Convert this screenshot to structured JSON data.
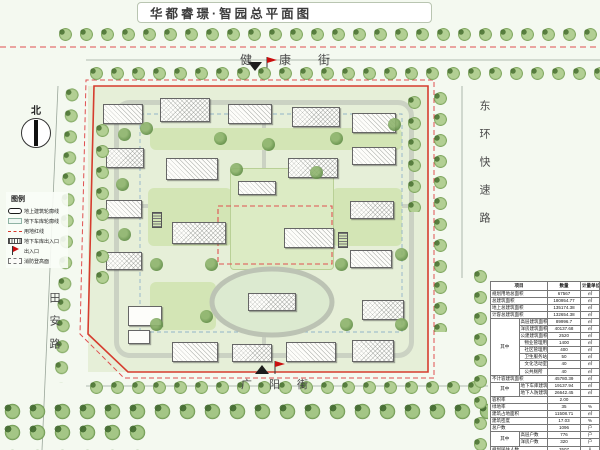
{
  "title": "华都睿璟·智园总平面图",
  "north_label": "北",
  "streets": {
    "top": "健康街",
    "bottom": "广阳街",
    "left": "田安路",
    "right": "东环快速路"
  },
  "legend": {
    "title": "图例",
    "items": [
      {
        "symbol": "building-outline",
        "label": "地上建筑轮廓线"
      },
      {
        "symbol": "garage-outline",
        "label": "地下车库轮廓线"
      },
      {
        "symbol": "red-line",
        "label": "用地红线"
      },
      {
        "symbol": "garage-ramp",
        "label": "地下车库出入口"
      },
      {
        "symbol": "entrance-flag",
        "label": "出入口"
      },
      {
        "symbol": "fire-lane",
        "label": "消防登高面"
      }
    ]
  },
  "table": {
    "headers": [
      "项目",
      "数量",
      "计量单位"
    ],
    "rows": [
      {
        "label": "规划用地总面积",
        "value": "67567",
        "unit": "㎡"
      },
      {
        "label": "总建筑面积",
        "value": "180954.77",
        "unit": "㎡"
      },
      {
        "label": "地上总建筑面积",
        "value": "135174.38",
        "unit": "㎡"
      },
      {
        "label": "计容总建筑面积",
        "value": "132654.38",
        "unit": "㎡"
      },
      {
        "group": "其中",
        "span": 8,
        "label": "高层建筑面积",
        "value": "89996.7",
        "unit": "㎡"
      },
      {
        "label": "洋房建筑面积",
        "value": "40137.68",
        "unit": "㎡"
      },
      {
        "label": "公建建筑面积",
        "value": "2520",
        "unit": "㎡"
      },
      {
        "indent": 1,
        "label": "物业管理用房",
        "value": "1400",
        "unit": "㎡"
      },
      {
        "indent": 1,
        "label": "社区管理用房",
        "value": "400",
        "unit": "㎡"
      },
      {
        "indent": 1,
        "label": "卫生服务站",
        "value": "50",
        "unit": "㎡"
      },
      {
        "indent": 1,
        "label": "文化活动室",
        "value": "40",
        "unit": "㎡"
      },
      {
        "indent": 1,
        "label": "公共厕所",
        "value": "40",
        "unit": "㎡"
      },
      {
        "label": "不计容建筑面积",
        "value": "45780.39",
        "unit": "㎡"
      },
      {
        "group": "其中",
        "span": 2,
        "label": "地下车库建筑面积",
        "value": "19137.94",
        "unit": "㎡"
      },
      {
        "label": "地下人防建筑面积",
        "value": "26642.45",
        "unit": "㎡"
      },
      {
        "label": "容积率",
        "value": "2.00",
        "unit": ""
      },
      {
        "label": "绿地率",
        "value": "35",
        "unit": "%"
      },
      {
        "label": "建筑占地面积",
        "value": "11508.71",
        "unit": "㎡"
      },
      {
        "label": "建筑密度",
        "value": "17.03",
        "unit": "%"
      },
      {
        "label": "总户数",
        "value": "1096",
        "unit": "户"
      },
      {
        "group": "其中",
        "span": 2,
        "label": "高层户数",
        "value": "776",
        "unit": "户"
      },
      {
        "label": "洋房户数",
        "value": "320",
        "unit": "户"
      },
      {
        "label": "规划居住人数",
        "value": "3507",
        "unit": "人"
      },
      {
        "label": "机动车停车位",
        "value": "1352",
        "unit": "辆"
      },
      {
        "label": "非机动车停车位",
        "value": "2166",
        "unit": "辆"
      }
    ]
  },
  "colors": {
    "boundary_red": "#d63c2e",
    "red_dashed": "#e05050",
    "tree_green": "#7aa25a",
    "site_green": "#e6efd8"
  }
}
